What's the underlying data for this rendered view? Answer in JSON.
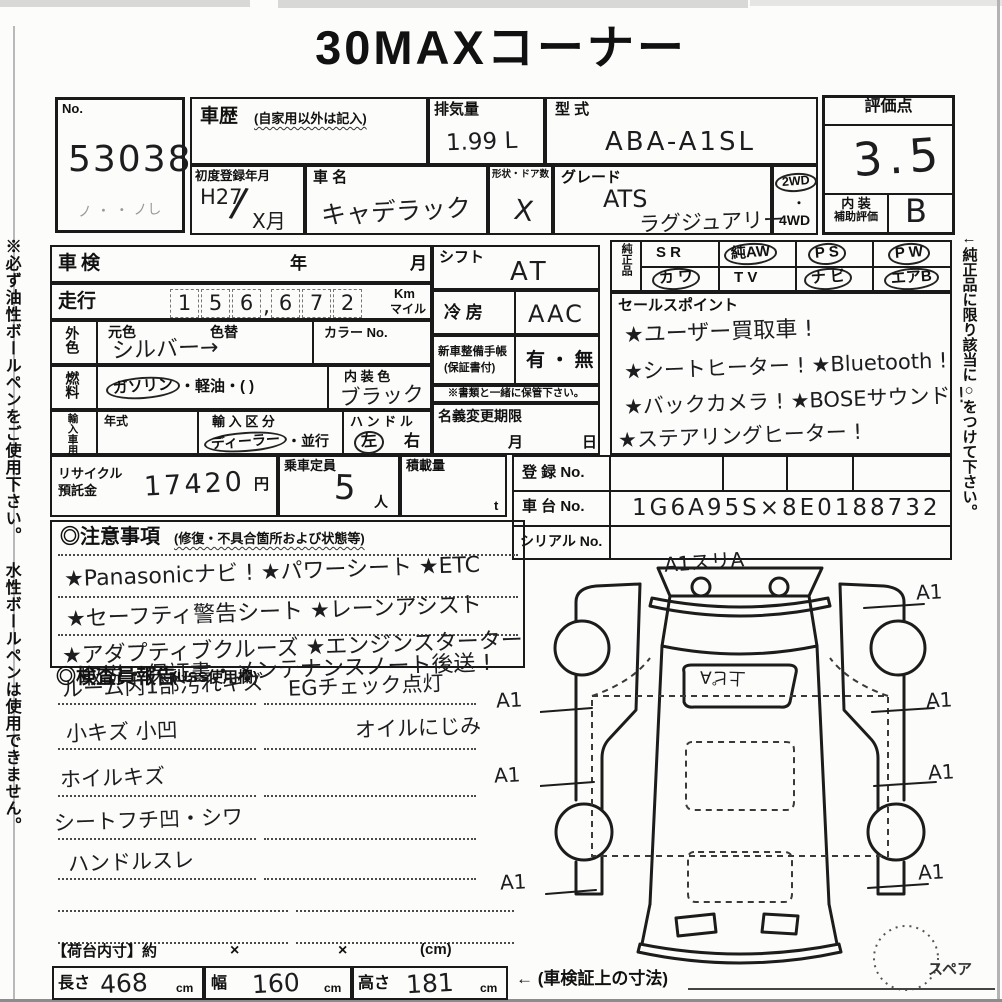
{
  "page": {
    "title": "30MAXコーナー",
    "left_note": "※必ず油性ボールペンをご使用下さい。 水性ボールペンは使用できません。",
    "right_note": "←純正品に限り該当に○をつけて下さい。"
  },
  "no_box": {
    "label": "No.",
    "value": "53038",
    "scribble": "ノ ・ ・ ノし"
  },
  "header": {
    "history": {
      "label": "車歴",
      "note": "(自家用以外は記入)"
    },
    "disp": {
      "label": "排気量",
      "value": "1.99 L"
    },
    "model": {
      "label": "型 式",
      "value": "ABA-A1SL"
    },
    "reg": {
      "label": "初度登録年月",
      "era": "H27",
      "slash": "/",
      "month": "X月"
    },
    "name": {
      "label": "車 名",
      "value": "キャデラック"
    },
    "shape": {
      "label": "形状・ドア数",
      "value": "X"
    },
    "grade": {
      "label": "グレード",
      "line1": "ATS",
      "line2": "ラグジュアリー"
    },
    "drive": {
      "opt1": "2WD",
      "dot": "・",
      "opt2": "4WD"
    },
    "score": {
      "label": "評価点",
      "value": "3.5",
      "int1": "内 装",
      "int2": "補助評価",
      "int_value": "B"
    }
  },
  "vehicle": {
    "shaken": {
      "label": "車検",
      "year": "年",
      "month": "月"
    },
    "mileage": {
      "label": "走行",
      "d": [
        "1",
        "5",
        "6",
        "6",
        "7",
        "2"
      ],
      "comma": ",",
      "unit1": "Km",
      "unit2": "マイル"
    },
    "ext": {
      "side": "外色",
      "h1": "元色",
      "h2": "色替",
      "value": "シルバー→",
      "color_no": "カラー No."
    },
    "fuel": {
      "side": "燃料",
      "circled": "ガソリン",
      "rest": "・軽油・(            )",
      "int_label": "内 装 色",
      "int_value": "ブラック"
    },
    "imp": {
      "side": "輸入車用",
      "y_label": "年式",
      "d_label": "輸 入 区 分",
      "d_circ": "ディーラー",
      "d_rest": "・並行",
      "h_label": "ハ ン ド ル",
      "left": "左",
      "right": "右"
    }
  },
  "mid": {
    "shift": {
      "label": "シフト",
      "value": "AT"
    },
    "ac": {
      "label": "冷 房",
      "value": "AAC"
    },
    "book": {
      "l1": "新車整備手帳",
      "l2": "(保証書付)",
      "value": "有 ・ 無",
      "note": "※書類と一緒に保管下さい。"
    },
    "transfer": {
      "label": "名義変更期限",
      "month": "月",
      "day": "日"
    }
  },
  "genuine": {
    "label": "純正品",
    "items": [
      {
        "label": "S R",
        "circled": false
      },
      {
        "label": "純AW",
        "circled": true
      },
      {
        "label": "P S",
        "circled": true
      },
      {
        "label": "P W",
        "circled": true
      },
      {
        "label": "カ ワ",
        "circled": true
      },
      {
        "label": "T V",
        "circled": false
      },
      {
        "label": "ナ ビ",
        "circled": true
      },
      {
        "label": "エアB",
        "circled": true
      }
    ]
  },
  "sales": {
    "label": "セールスポイント",
    "lines": [
      "★ユーザー買取車 !",
      "★シートヒーター ! ★Bluetooth !",
      "★バックカメラ ! ★BOSEサウンド !",
      "★ステアリングヒーター !"
    ]
  },
  "fees": {
    "r1": "リサイクル",
    "r2": "預託金",
    "value": "17420",
    "yen": "円",
    "cap_label": "乗車定員",
    "cap": "5",
    "nin": "人",
    "load_label": "積載量",
    "t": "t"
  },
  "regnos": {
    "reg_label": "登 録 No.",
    "chassis_label": "車 台 No.",
    "chassis": "1G6A95S×8E0188732",
    "serial_label": "シリアル No."
  },
  "cautions": {
    "title": "◎注意事項",
    "note": "(修復・不具合箇所および状態等)",
    "lines": [
      "★Panasonicナビ !  ★パワーシート  ★ETC",
      "★セーフティ警告シート  ★レーンアシスト",
      "★アダプティブクルーズ  ★エンジンスターター",
      "取説・保証書・メンテナンスノート後送 !"
    ]
  },
  "inspector": {
    "title": "◎検査員報告",
    "note": "(USS使用欄)",
    "left_lines": [
      "ルーム内1部汚れキズ",
      "小キズ 小凹",
      "ホイルキズ",
      "シートフチ凹・シワ",
      "ハンドルスレ"
    ],
    "right_lines": [
      "EGチェック点灯",
      "オイルにじみ"
    ]
  },
  "diagram": {
    "top": "A1スリA",
    "glass": "上ピA",
    "a1": "A1",
    "spare": "スペア"
  },
  "cargo": {
    "label": "【荷台内寸】約",
    "x": "×",
    "unit": "(cm)",
    "len_l": "長さ",
    "len": "468",
    "w_l": "幅",
    "w": "160",
    "h_l": "高さ",
    "h": "181",
    "cm": "cm",
    "note": "← (車検証上の寸法)"
  }
}
